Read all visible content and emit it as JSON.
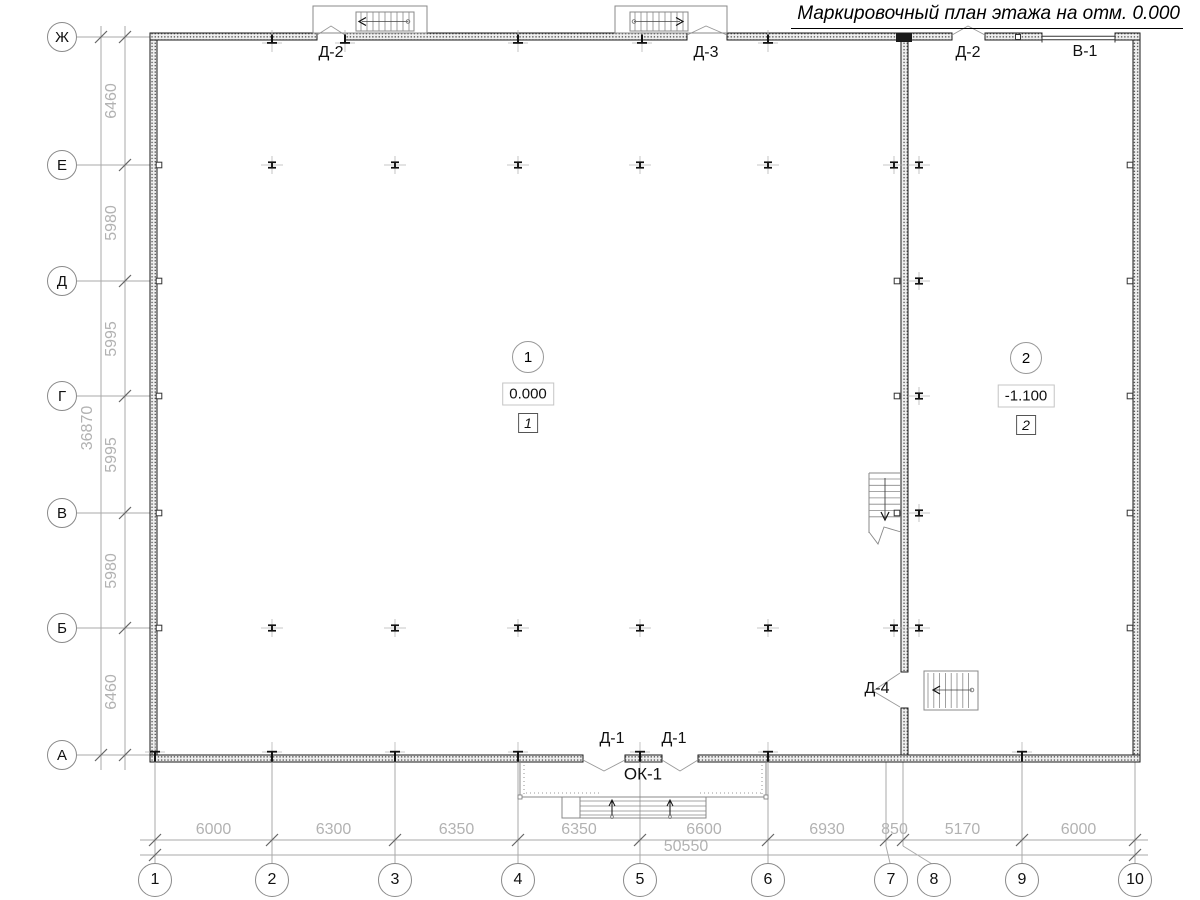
{
  "title": "Маркировочный план этажа на отм. 0.000",
  "axes": {
    "rows": [
      "Ж",
      "Е",
      "Д",
      "Г",
      "В",
      "Б",
      "А"
    ],
    "cols": [
      "1",
      "2",
      "3",
      "4",
      "5",
      "6",
      "7",
      "8",
      "9",
      "10"
    ]
  },
  "dimensions": {
    "left": {
      "segments": [
        "6460",
        "5980",
        "5995",
        "5995",
        "5980",
        "6460"
      ],
      "total": "36870"
    },
    "bottom": {
      "segments": [
        "6000",
        "6300",
        "6350",
        "6350",
        "6600",
        "6930",
        "850",
        "5170",
        "6000"
      ],
      "total": "50550"
    }
  },
  "rooms": [
    {
      "number": "1",
      "elevation": "0.000",
      "tag": "1"
    },
    {
      "number": "2",
      "elevation": "-1.100",
      "tag": "2"
    }
  ],
  "openings": {
    "top_left_door": "Д-2",
    "top_mid_door": "Д-3",
    "top_right_door": "Д-2",
    "top_gate": "В-1",
    "bottom_door_1": "Д-1",
    "bottom_door_2": "Д-1",
    "bottom_window": "ОК-1",
    "mid_door": "Д-4"
  }
}
